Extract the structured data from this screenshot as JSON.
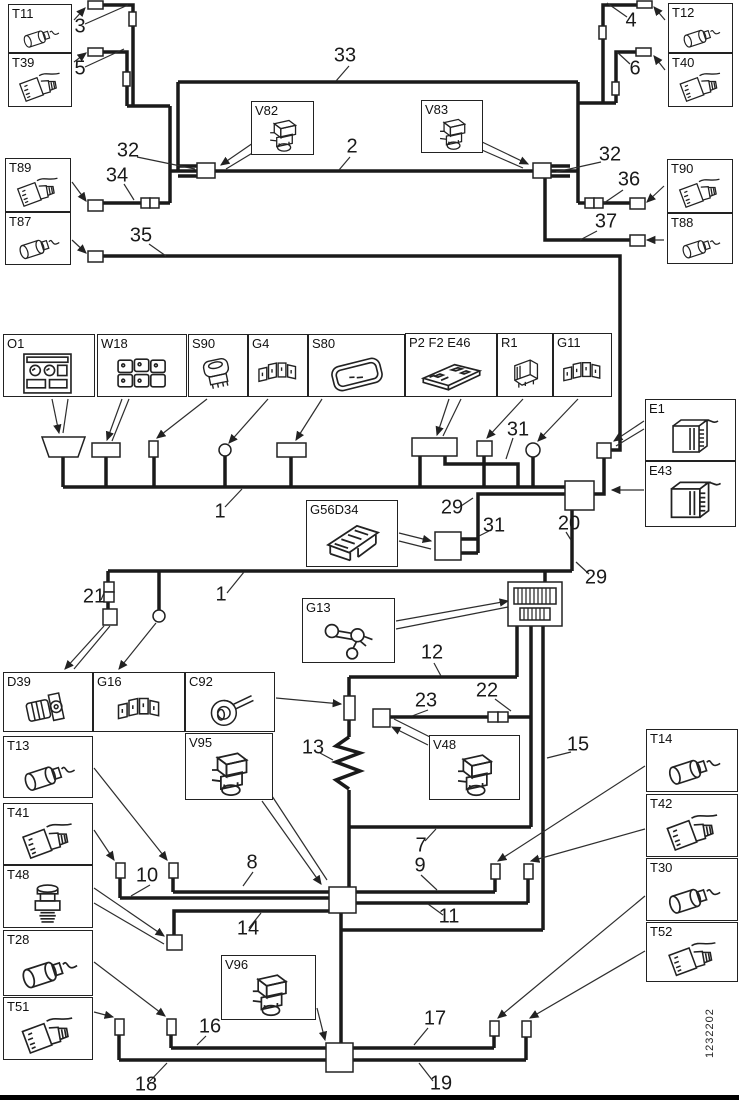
{
  "part_number": "1232202",
  "boxes": {
    "t11": {
      "label": "T11",
      "icon": "cylindrical-sensor-icon"
    },
    "t39": {
      "label": "T39",
      "icon": "plug-connector-icon"
    },
    "t12": {
      "label": "T12",
      "icon": "cylindrical-sensor-icon"
    },
    "t40": {
      "label": "T40",
      "icon": "plug-connector-icon"
    },
    "t89": {
      "label": "T89",
      "icon": "plug-connector-icon"
    },
    "t87": {
      "label": "T87",
      "icon": "cylindrical-sensor-icon"
    },
    "t90": {
      "label": "T90",
      "icon": "plug-connector-icon"
    },
    "t88": {
      "label": "T88",
      "icon": "cylindrical-sensor-icon"
    },
    "v82": {
      "label": "V82",
      "icon": "solenoid-valve-icon"
    },
    "v83": {
      "label": "V83",
      "icon": "solenoid-valve-icon"
    },
    "o1": {
      "label": "O1",
      "icon": "instrument-cluster-icon"
    },
    "w18": {
      "label": "W18",
      "icon": "switch-pack-icon"
    },
    "s90": {
      "label": "S90",
      "icon": "rocker-switch-icon"
    },
    "g4": {
      "label": "G4",
      "icon": "connector-block-icon"
    },
    "s80": {
      "label": "S80",
      "icon": "control-plate-icon"
    },
    "p2f2e46": {
      "label": "P2 F2 E46",
      "icon": "circuit-board-icon"
    },
    "r1": {
      "label": "R1",
      "icon": "relay-icon"
    },
    "g11": {
      "label": "G11",
      "icon": "connector-block-icon"
    },
    "e1": {
      "label": "E1",
      "icon": "control-unit-icon"
    },
    "e43": {
      "label": "E43",
      "icon": "control-unit-icon"
    },
    "g56d34": {
      "label": "G56D34",
      "icon": "frame-bracket-icon"
    },
    "g13": {
      "label": "G13",
      "icon": "bracket-icon"
    },
    "d39": {
      "label": "D39",
      "icon": "motor-icon"
    },
    "g16": {
      "label": "G16",
      "icon": "connector-block-icon"
    },
    "c92": {
      "label": "C92",
      "icon": "horn-icon"
    },
    "t13": {
      "label": "T13",
      "icon": "cylindrical-sensor-icon"
    },
    "v95": {
      "label": "V95",
      "icon": "solenoid-valve-icon"
    },
    "t41": {
      "label": "T41",
      "icon": "plug-connector-icon"
    },
    "t48": {
      "label": "T48",
      "icon": "pressure-sensor-icon"
    },
    "t28": {
      "label": "T28",
      "icon": "cylindrical-sensor-icon"
    },
    "t51": {
      "label": "T51",
      "icon": "plug-connector-icon"
    },
    "v48": {
      "label": "V48",
      "icon": "solenoid-valve-icon"
    },
    "v96": {
      "label": "V96",
      "icon": "solenoid-valve-icon"
    },
    "t14": {
      "label": "T14",
      "icon": "cylindrical-sensor-icon"
    },
    "t42": {
      "label": "T42",
      "icon": "plug-connector-icon"
    },
    "t30": {
      "label": "T30",
      "icon": "cylindrical-sensor-icon"
    },
    "t52": {
      "label": "T52",
      "icon": "plug-connector-icon"
    }
  },
  "callouts": {
    "c3": "3",
    "c5": "5",
    "c4": "4",
    "c6": "6",
    "c33": "33",
    "c2": "2",
    "c32_left": "32",
    "c34": "34",
    "c35": "35",
    "c32_right": "32",
    "c36": "36",
    "c37": "37",
    "c31_top": "31",
    "c29_top": "29",
    "c31_mid": "31",
    "c20": "20",
    "c29_mid": "29",
    "c1_top": "1",
    "c21": "21",
    "c1_bottom": "1",
    "c12": "12",
    "c23": "23",
    "c22": "22",
    "c13": "13",
    "c15": "15",
    "c7": "7",
    "c9": "9",
    "c8": "8",
    "c10": "10",
    "c11": "11",
    "c14": "14",
    "c16": "16",
    "c17": "17",
    "c18": "18",
    "c19": "19"
  }
}
